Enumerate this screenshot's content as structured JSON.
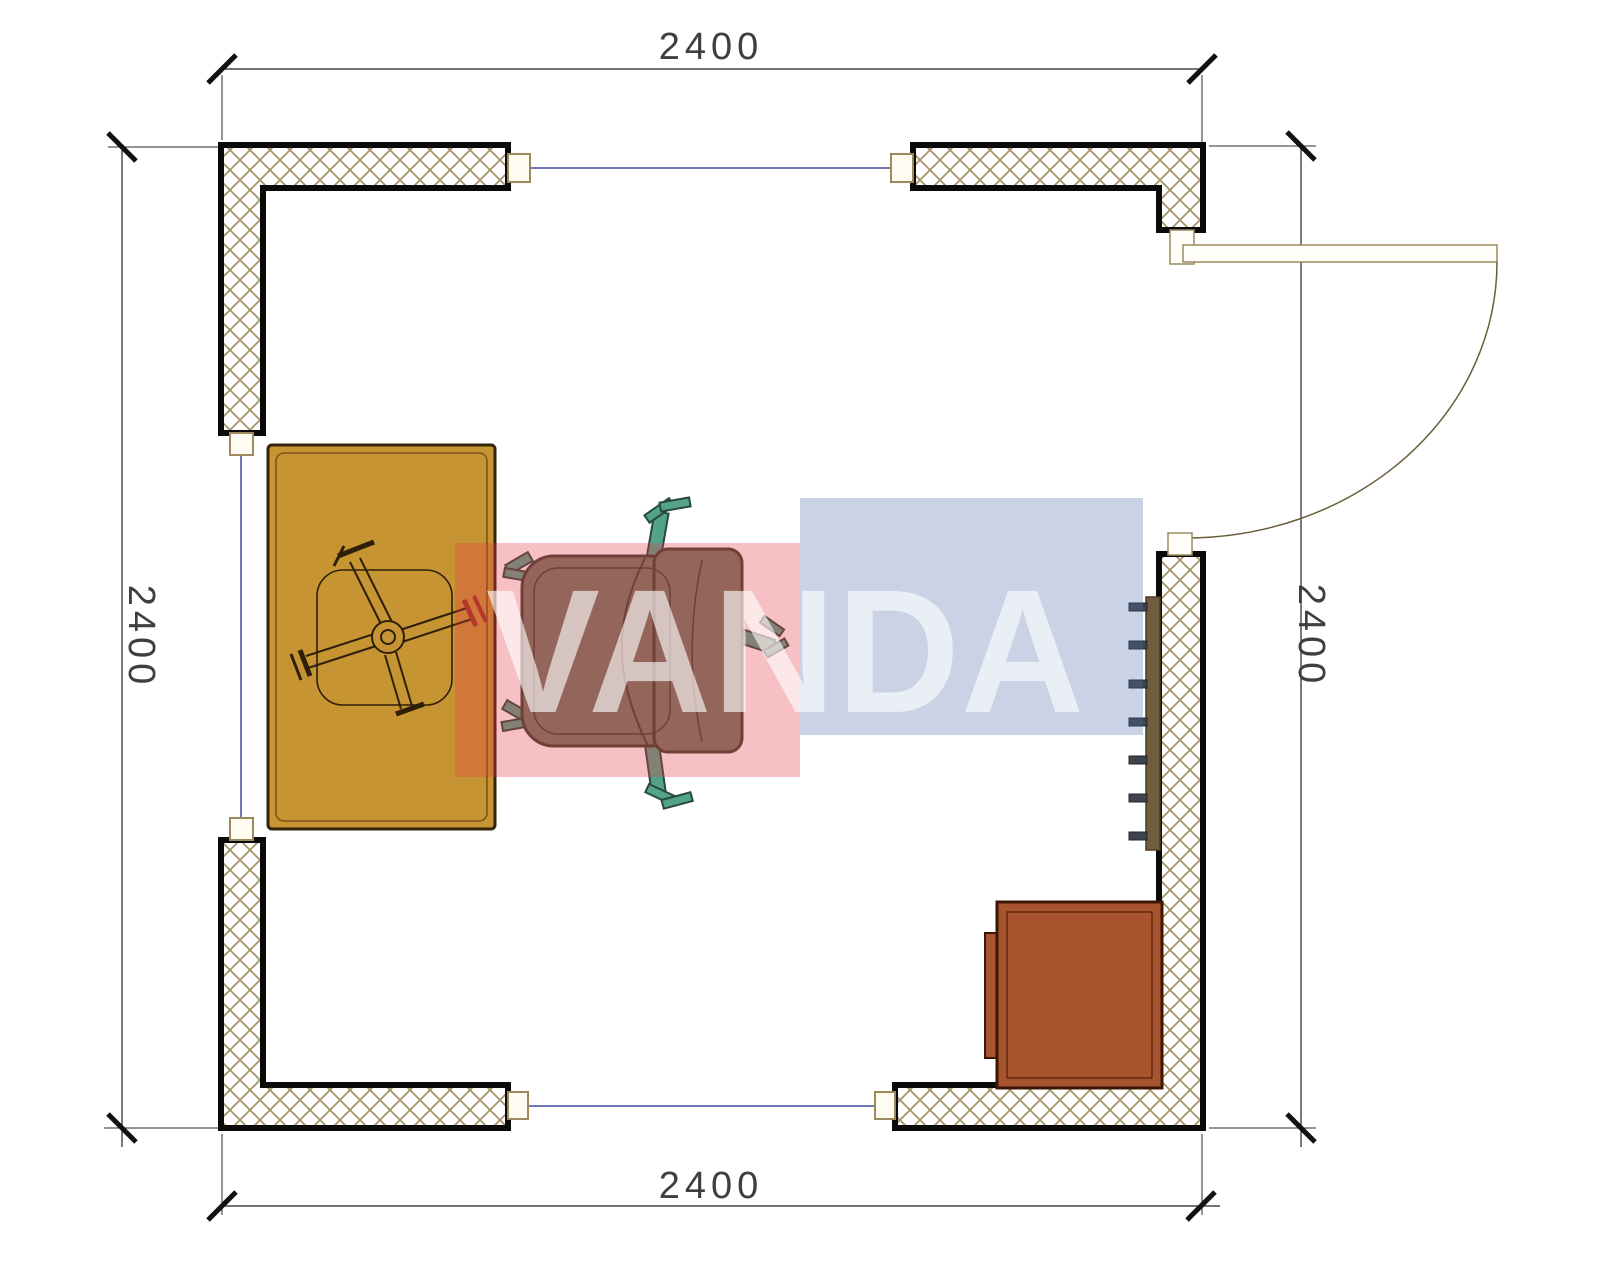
{
  "drawing_type": "floor-plan",
  "dimensions": {
    "top": "2400",
    "bottom": "2400",
    "left": "2400",
    "right": "2400"
  },
  "watermark": {
    "text": "VANDA",
    "pink_block_color": "#E73A48",
    "blue_block_color": "#5270AC",
    "letter_color": "#FFFFFF"
  },
  "colors": {
    "desk_fill": "#C79434",
    "cabinet_fill": "#A8552F",
    "chair_body": "#6E7A64",
    "chair_legs": "#55A28B",
    "radiator_strip": "#6F5E3E",
    "radiator_tabs": "#3F434B",
    "wall_hatch_line": "#A6956B",
    "wall_outline": "#0A0A0A",
    "joint_line": "#3D4A9E",
    "dimension_line": "#222222"
  }
}
